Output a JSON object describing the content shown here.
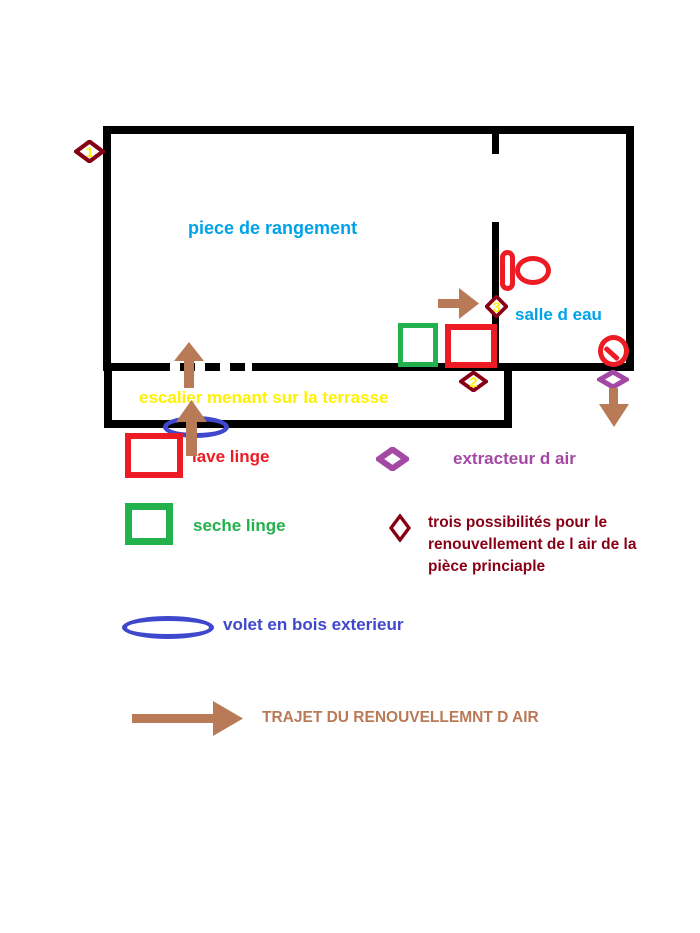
{
  "colors": {
    "wall_black": "#000000",
    "red": "#ED1C24",
    "green": "#22B14C",
    "blue": "#3F48CC",
    "purple": "#A349A4",
    "dark_red": "#880015",
    "yellow": "#FFF200",
    "cyan_blue": "#00A2E8",
    "brown": "#B97A57"
  },
  "plan": {
    "main_room_label": "piece de rangement",
    "bathroom_label": "salle d eau",
    "stairs_label": "escalier menant sur la terrasse",
    "markers": [
      {
        "label": "1"
      },
      {
        "label": "2"
      },
      {
        "label": "3"
      }
    ]
  },
  "legend": {
    "items": [
      {
        "symbol": "red-square",
        "label": "lave linge",
        "color": "#ED1C24"
      },
      {
        "symbol": "purple-diamond",
        "label": "extracteur d air",
        "color": "#A349A4"
      },
      {
        "symbol": "green-square",
        "label": "seche linge",
        "color": "#22B14C"
      },
      {
        "symbol": "dark-red-diamond",
        "label": "trois possibilités pour le renouvellement de l air de la pièce princiaple",
        "color": "#880015"
      },
      {
        "symbol": "blue-ellipse",
        "label": "volet en bois exterieur",
        "color": "#3F48CC"
      },
      {
        "symbol": "brown-arrow",
        "label": "TRAJET DU RENOUVELLEMNT D AIR",
        "color": "#B97A57"
      }
    ]
  }
}
